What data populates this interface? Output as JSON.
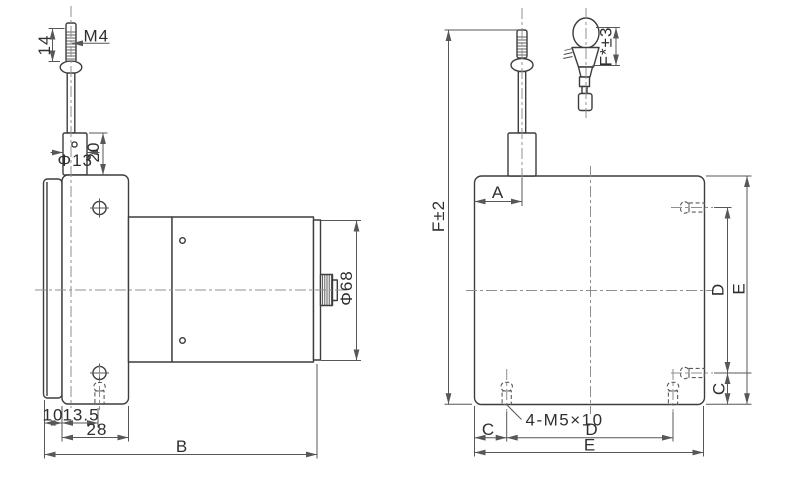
{
  "drawing": {
    "kind": "draw-wire-sensor dimension drawing",
    "labels": {
      "m4": "M4",
      "len_14": "14",
      "dia_13": "Φ13",
      "len_20": "20",
      "len_10": "10",
      "len_13_5": "13.5",
      "len_28": "28",
      "len_b": "B",
      "dia_68": "Φ68",
      "f_total": "F±2",
      "len_a": "A",
      "f_grip": "F*±3",
      "screw_note": "4-M5×10",
      "len_c_bottom": "C",
      "len_d_bottom": "D",
      "len_e_bottom": "E",
      "len_c_right": "C",
      "len_d_right": "D",
      "len_e_right": "E"
    },
    "colors": {
      "outline": "#3d3d3d",
      "dimension": "#575757",
      "centerline": "#8f8f8f",
      "hidden_line": "#5a5a5a",
      "text": "#2e2e2e",
      "background": "#ffffff"
    }
  }
}
